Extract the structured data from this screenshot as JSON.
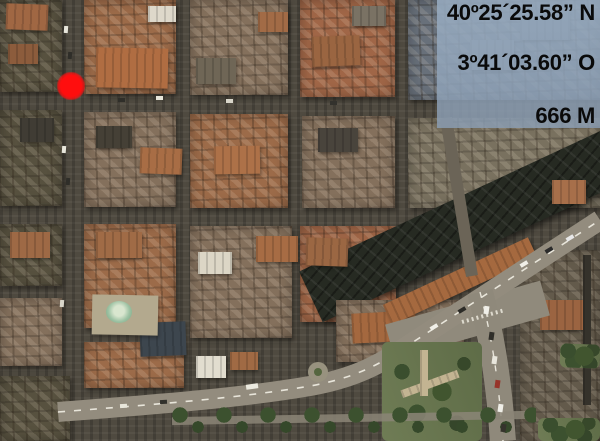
{
  "map": {
    "kind": "satellite aerial city view",
    "marker": {
      "name": "location-marker",
      "color": "#ff0000"
    }
  },
  "coordinates_overlay": {
    "latitude": "40º25´25.58” N",
    "longitude": "3º41´03.60” O",
    "elevation": "666 M",
    "panel_color": "#94a8bc",
    "text_color": "#000000"
  }
}
